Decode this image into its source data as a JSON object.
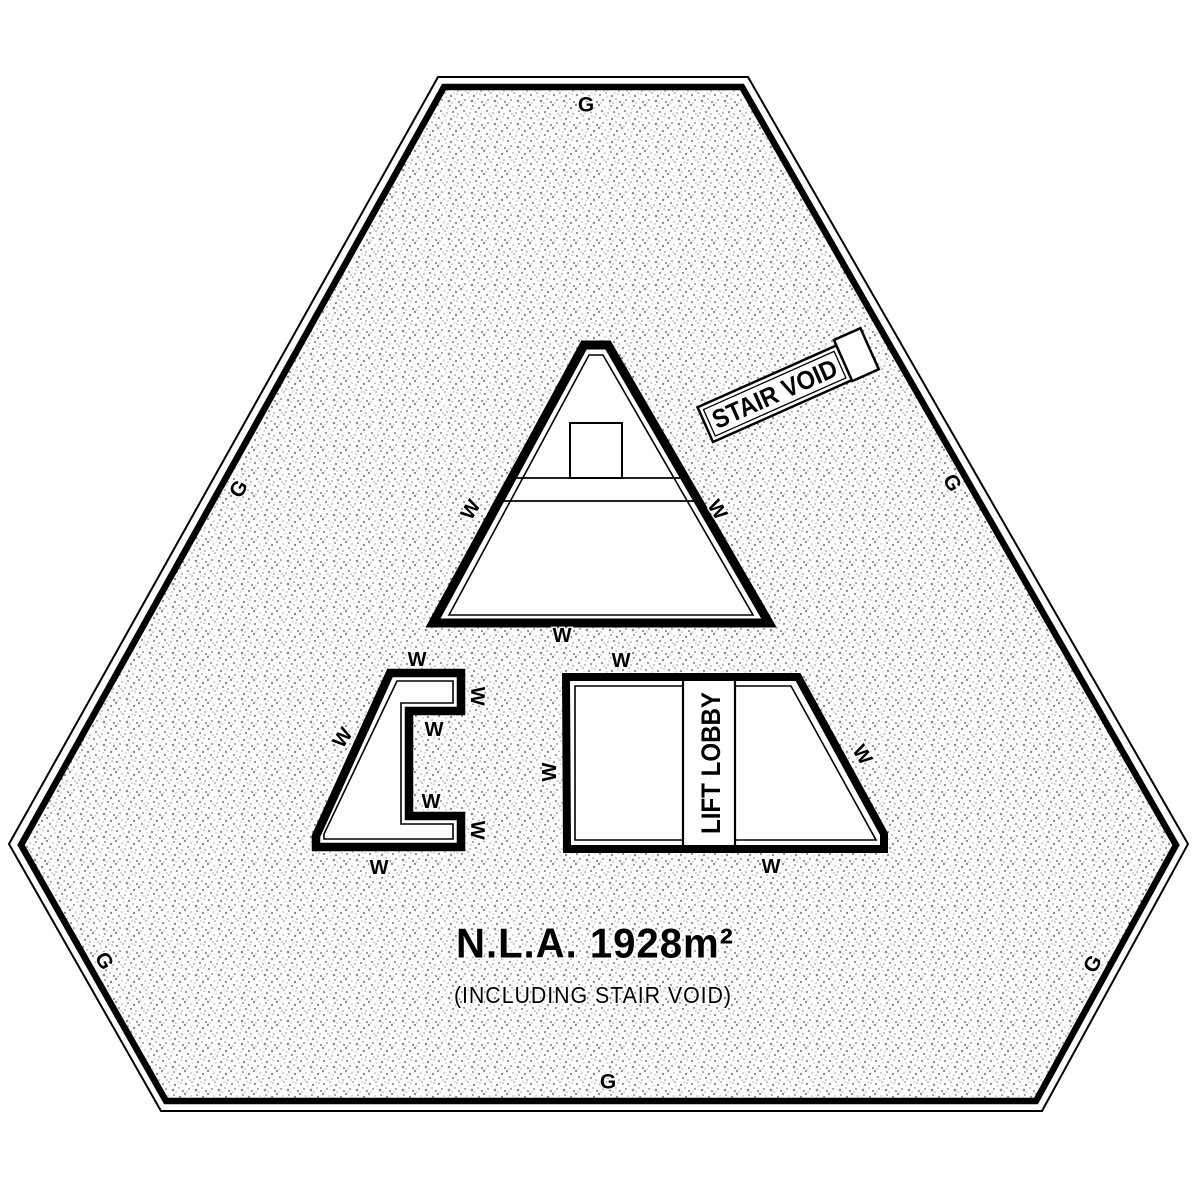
{
  "plan": {
    "nla": "N.L.A. 1928m²",
    "nla_note": "(INCLUDING STAIR VOID)"
  },
  "rooms": {
    "stair_void": "STAIR VOID",
    "lift_lobby": "LIFT LOBBY"
  },
  "markers": {
    "glazing": "G",
    "wall": "W"
  },
  "colors": {
    "ink": "#000000",
    "speckle": "#8f8f8f",
    "paper": "#ffffff"
  }
}
